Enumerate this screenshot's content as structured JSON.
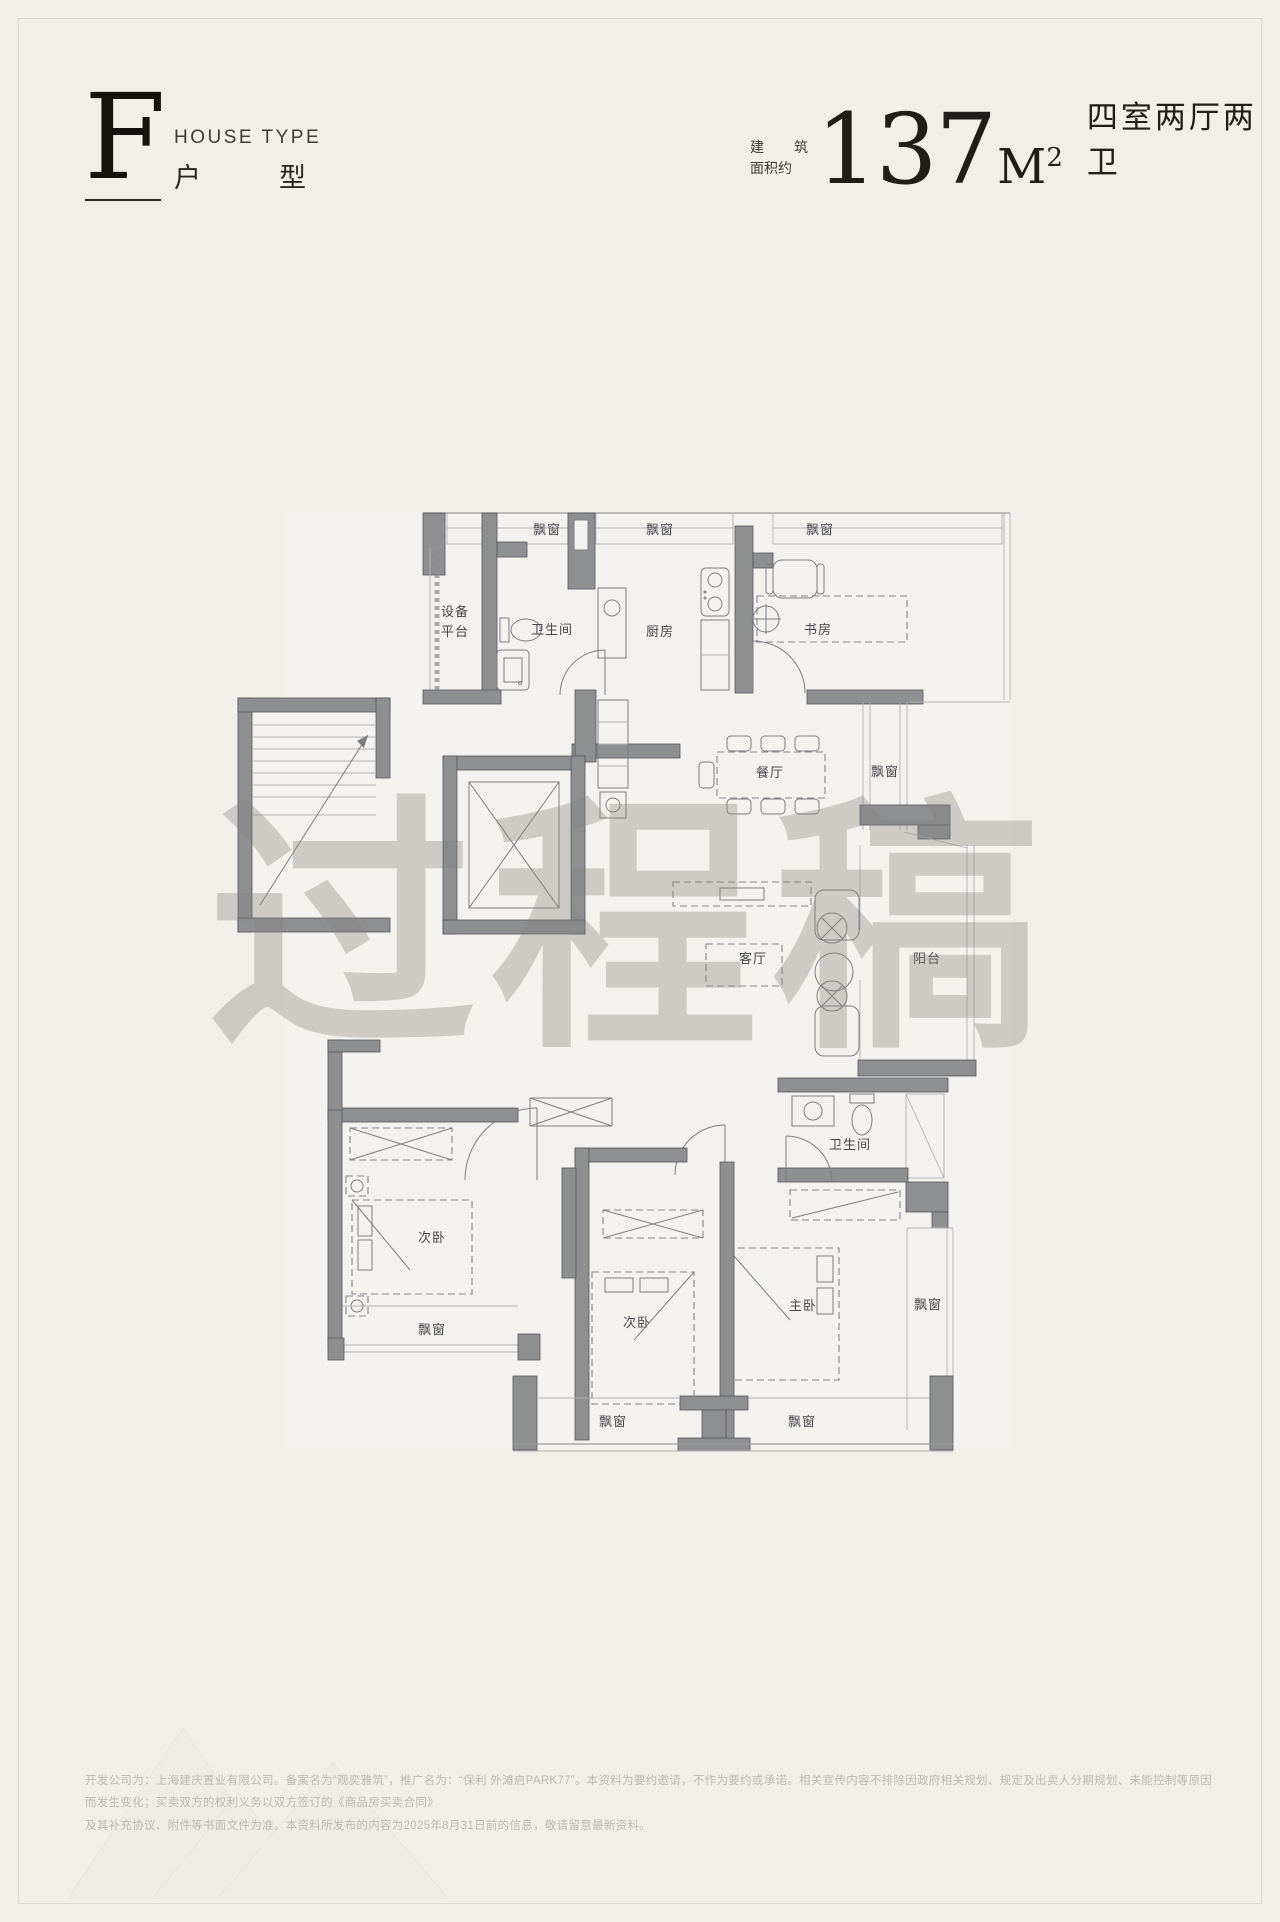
{
  "header": {
    "letter": "F",
    "label_en": "HOUSE TYPE",
    "label_zh_left": "户",
    "label_zh_right": "型"
  },
  "area": {
    "prefix_top_left": "建",
    "prefix_top_right": "筑",
    "prefix_bottom": "面积约",
    "value": "137",
    "unit_base": "M",
    "unit_sup": "2",
    "rooms_text": "四室两厅两卫"
  },
  "floorplan": {
    "labels": [
      {
        "text": "飘窗"
      },
      {
        "text": "飘窗"
      },
      {
        "text": "飘窗"
      },
      {
        "text": "设备"
      },
      {
        "text": "平台"
      },
      {
        "text": "卫生间"
      },
      {
        "text": "厨房"
      },
      {
        "text": "书房"
      },
      {
        "text": "餐厅"
      },
      {
        "text": "飘窗"
      },
      {
        "text": "客厅"
      },
      {
        "text": "阳台"
      },
      {
        "text": "卫生间"
      },
      {
        "text": "次卧"
      },
      {
        "text": "飘窗"
      },
      {
        "text": "次卧"
      },
      {
        "text": "主卧"
      },
      {
        "text": "飘窗"
      },
      {
        "text": "飘窗"
      },
      {
        "text": "飘窗"
      }
    ]
  },
  "watermark": {
    "text": "过程稿"
  },
  "disclaimer": {
    "line1": "开发公司为：上海建庆置业有限公司。备案名为“观奕雅筑”，推广名为：“保利 外滩启PARK77”。本资料为要约邀请，不作为要约或承诺。相关宣传内容不排除因政府相关规划、规定及出卖人分期规划、未能控制等原因而发生变化；买卖双方的权利义务以双方签订的《商品房买卖合同》",
    "line2": "及其补充协议、附件等书面文件为准。本资料所发布的内容为2025年8月31日前的信息，敬请留意最新资料。"
  },
  "colors": {
    "wall": "#8e8f91",
    "text_dark": "#211d1a",
    "plan_label": "#46474a",
    "watermark": "#86837f",
    "disclaimer": "#bcb9b4",
    "background": "#f2efea"
  }
}
